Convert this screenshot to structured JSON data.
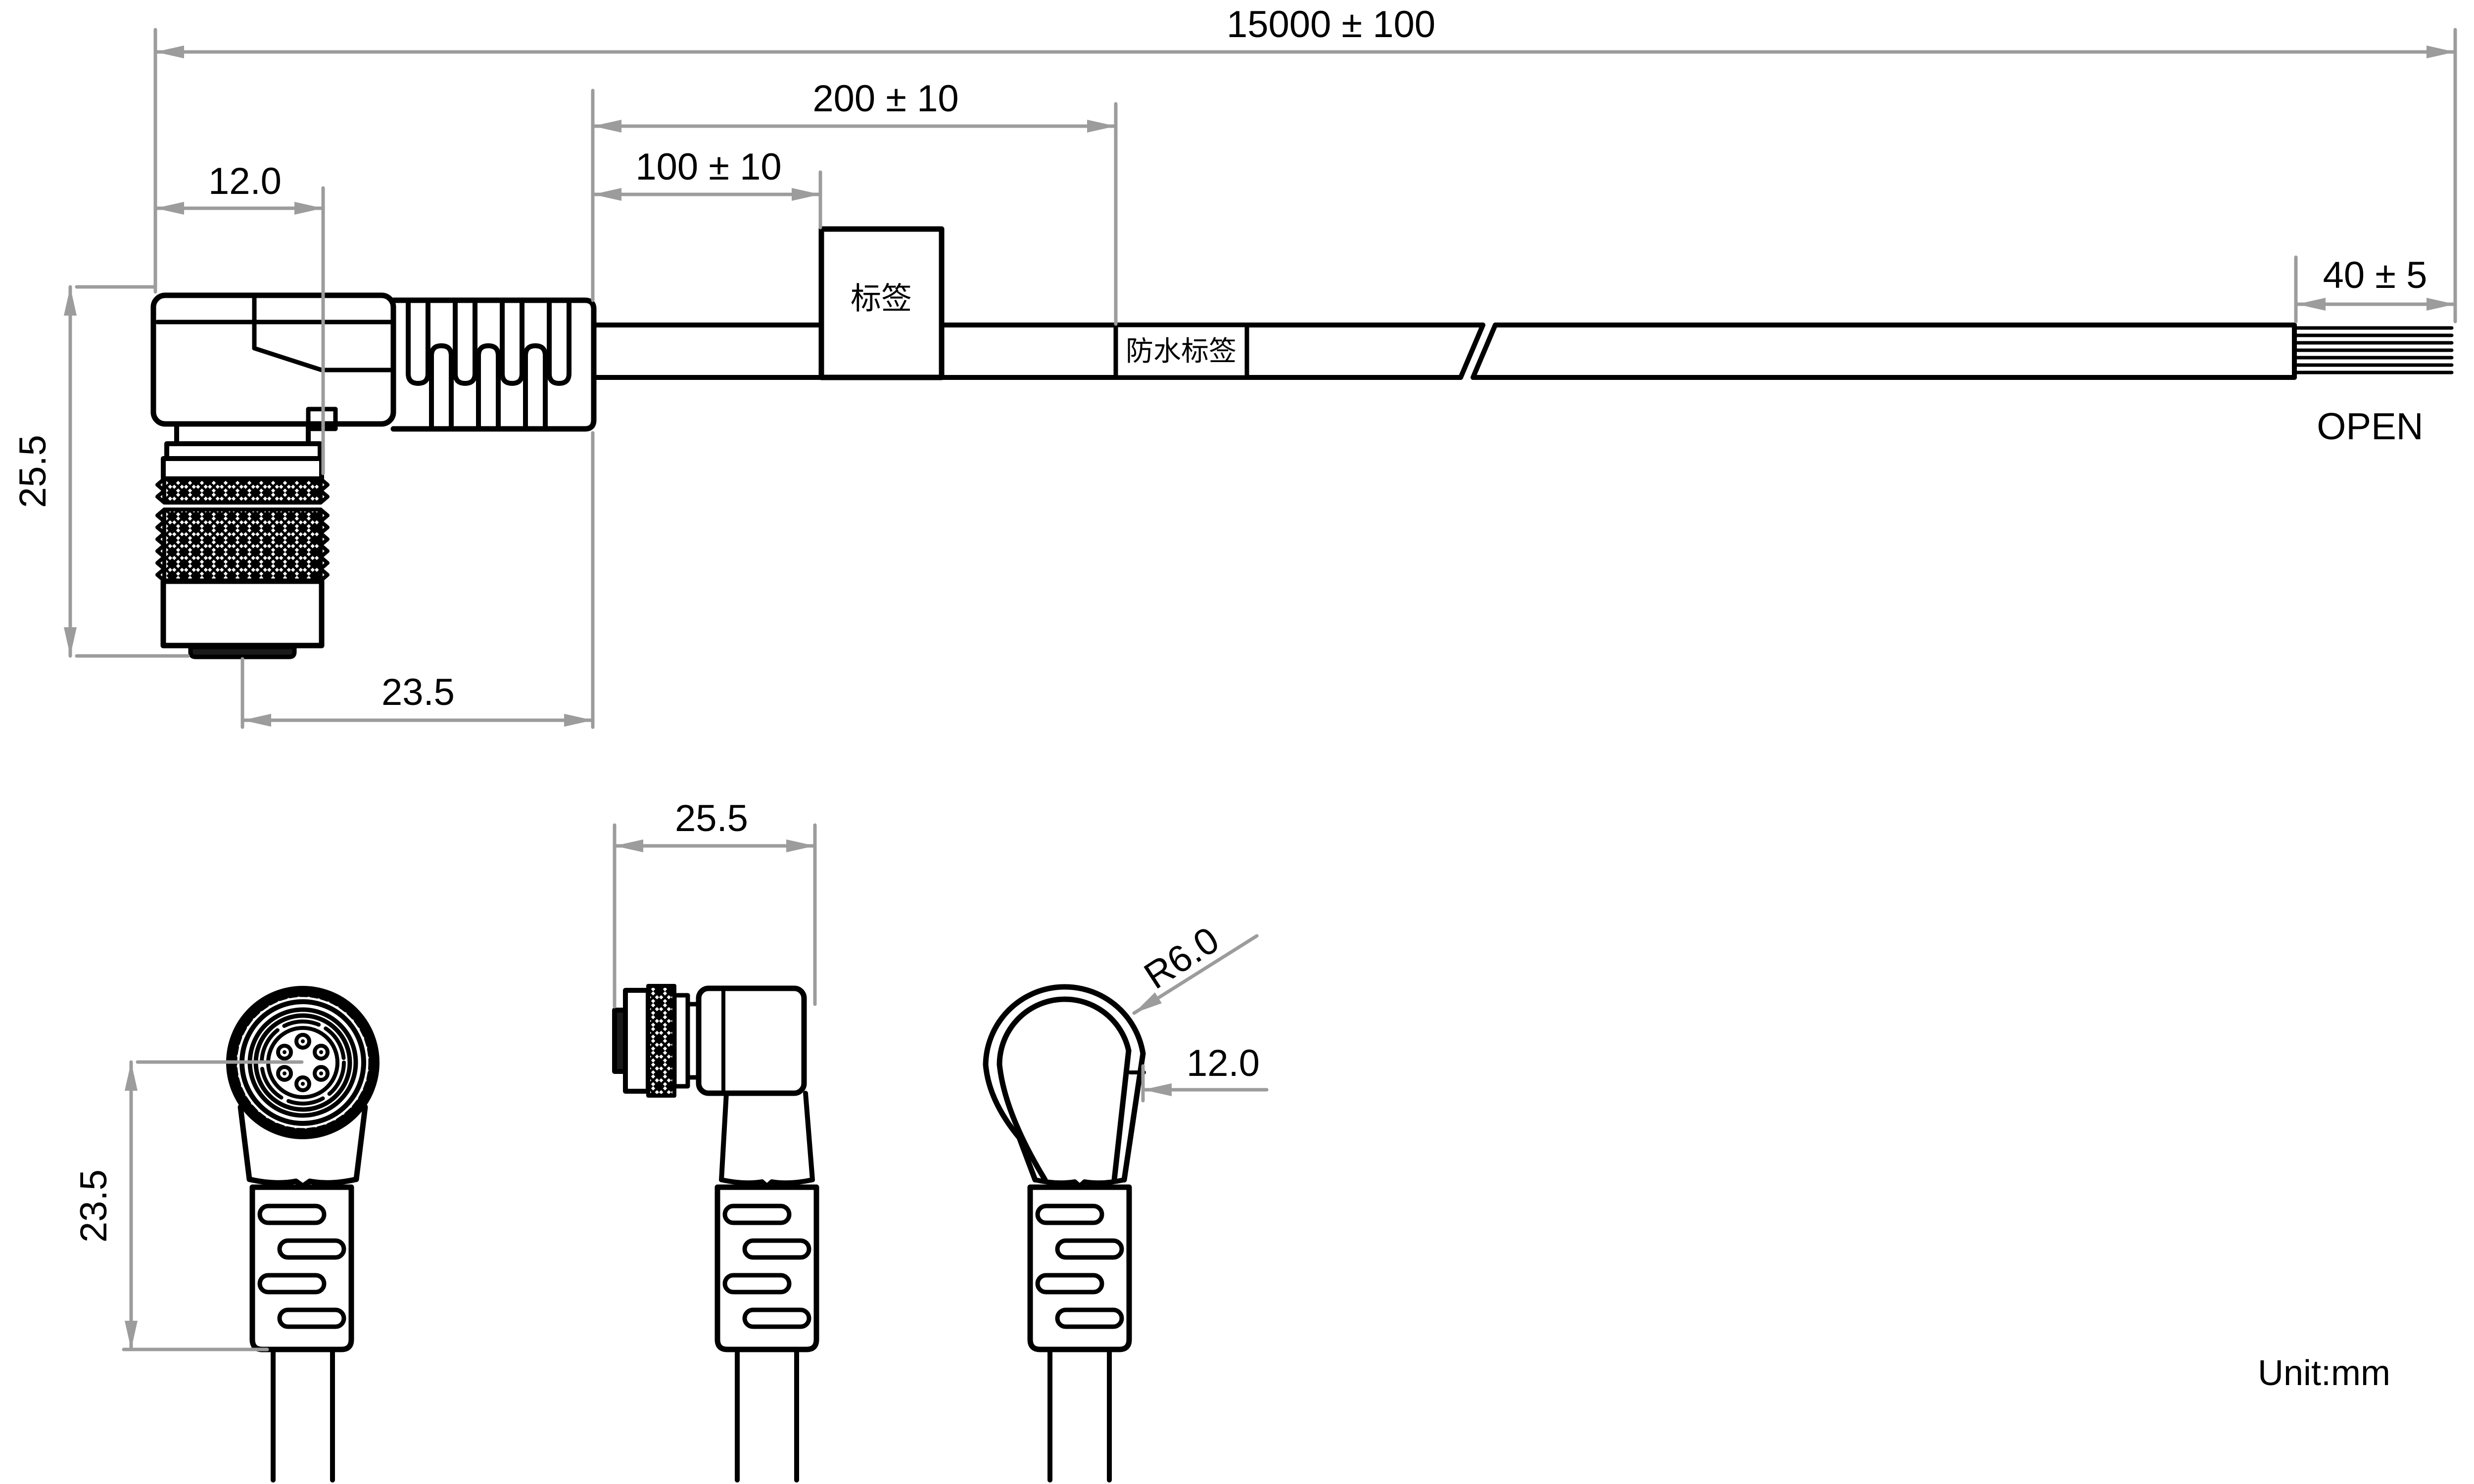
{
  "unit_note": "Unit:mm",
  "colors": {
    "line": "#000000",
    "dimension": "#9c9c9c",
    "background": "#ffffff"
  },
  "side_view": {
    "dims": {
      "overall_length": "15000 ± 100",
      "waterproof_label_distance": "200 ± 10",
      "label_distance": "100 ± 10",
      "body_width": "12.0",
      "connector_height": "25.5",
      "connector_depth": "23.5",
      "strip_length": "40 ± 5"
    },
    "labels": {
      "tag": "标签",
      "waterproof_tag": "防水标签",
      "open_end": "OPEN"
    }
  },
  "front_view": {
    "dims": {
      "depth": "23.5"
    }
  },
  "profile_view": {
    "dims": {
      "width": "25.5"
    }
  },
  "bend_view": {
    "dims": {
      "radius": "R6.0",
      "width": "12.0"
    }
  }
}
